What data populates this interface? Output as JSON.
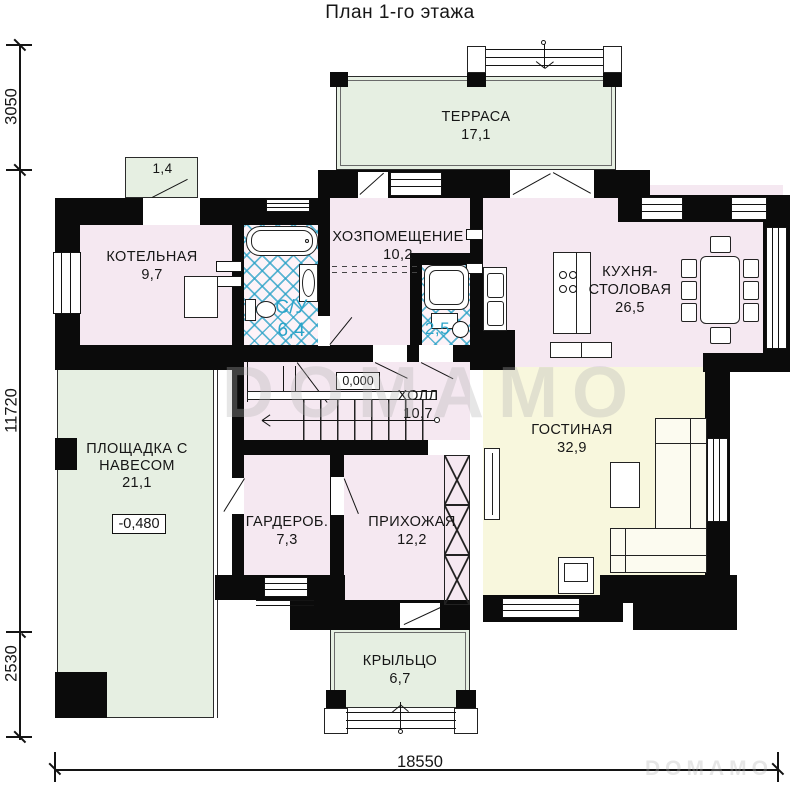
{
  "title": "План 1-го этажа",
  "watermarks": {
    "large": "DOMAMO",
    "small": "DOMAMO"
  },
  "dimensions": {
    "left_top": "3050",
    "left_middle": "11720",
    "left_bottom": "2530",
    "bottom": "18550"
  },
  "elevation_marks": {
    "hall_zero": "0,000",
    "platform": "-0,480"
  },
  "rooms": {
    "terrace": {
      "name": "ТЕРРАСА",
      "area": "17,1"
    },
    "canopy": {
      "area": "1,4"
    },
    "boiler": {
      "name": "КОТЕЛЬНАЯ",
      "area": "9,7"
    },
    "wc1": {
      "name": "С/У",
      "area": "6,4"
    },
    "utility": {
      "name": "ХОЗПОМЕЩЕНИЕ",
      "area": "10,2"
    },
    "wc2": {
      "area": "2,5"
    },
    "kitchen": {
      "name_line1": "КУХНЯ-",
      "name_line2": "СТОЛОВАЯ",
      "area": "26,5"
    },
    "platform": {
      "name": "ПЛОЩАДКА С НАВЕСОМ",
      "area": "21,1"
    },
    "hall": {
      "name": "ХОЛЛ",
      "area": "10,7"
    },
    "living": {
      "name": "ГОСТИНАЯ",
      "area": "32,9"
    },
    "wardrobe": {
      "name": "ГАРДЕРОБ.",
      "area": "7,3"
    },
    "entry": {
      "name": "ПРИХОЖАЯ",
      "area": "12,2"
    },
    "porch": {
      "name": "КРЫЛЬЦО",
      "area": "6,7"
    }
  },
  "colors": {
    "wall": "#0b0b0b",
    "room_pink": "#f5e8f1",
    "room_green": "#e6efe2",
    "room_cream": "#f8f7dd",
    "hatch_blue": "#2aa4c9"
  }
}
